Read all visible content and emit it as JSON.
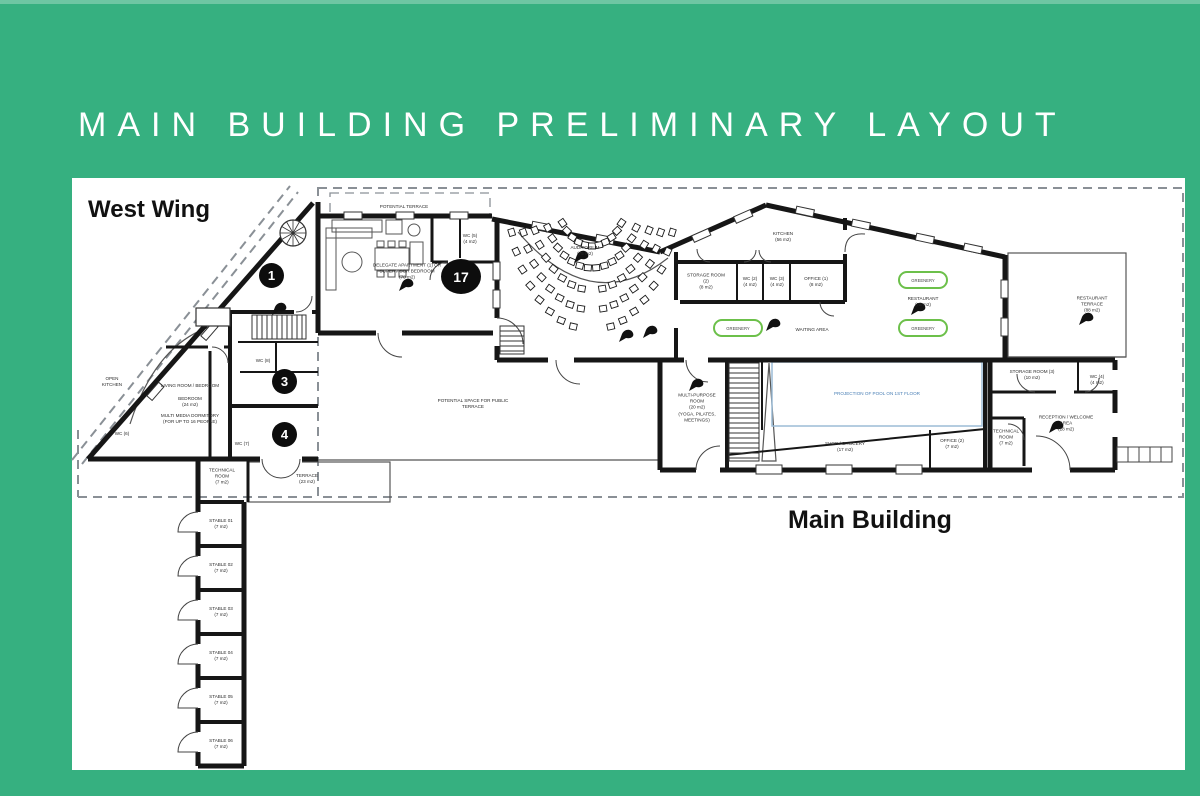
{
  "title": "MAIN BUILDING PRELIMINARY LAYOUT",
  "sections": {
    "west_wing": "West Wing",
    "main_building": "Main Building"
  },
  "colors": {
    "background": "#36B080",
    "wall": "#161616",
    "greenery": "#6CC04A",
    "pool_line": "#9CBCD6",
    "pool_text": "#4A7FB5",
    "dashed": "#8A9096"
  },
  "markers": {
    "m1": "1",
    "m3": "3",
    "m4": "4",
    "m17": "17"
  },
  "greenery_label": "GREENERY",
  "rooms": {
    "auditorium": {
      "name": "AUDITORIUM",
      "area": "(75 m2)"
    },
    "apartment": {
      "name": "DELEGATE APARTMENT (1) OR SUPERVISOR BEDROOM",
      "area": "(78 m2)"
    },
    "potential_terrace": {
      "name": "POTENTIAL TERRACE",
      "area": ""
    },
    "wc5": {
      "name": "WC (5)",
      "area": "(4 m2)"
    },
    "storage2": {
      "name": "STORAGE ROOM (2)",
      "area": "(8 m2)"
    },
    "wc2": {
      "name": "WC (2)",
      "area": "(4 m2)"
    },
    "wc3": {
      "name": "WC (3)",
      "area": "(4 m2)"
    },
    "office1": {
      "name": "OFFICE (1)",
      "area": "(8 m2)"
    },
    "kitchen": {
      "name": "KITCHEN",
      "area": "(56 m2)"
    },
    "waiting": {
      "name": "WAITING AREA",
      "area": ""
    },
    "restaurant": {
      "name": "RESTAURANT",
      "area": "(78 m2)"
    },
    "restaurant_terrace": {
      "name": "RESTAURANT TERRACE",
      "area": "(88 m2)"
    },
    "public_terrace": {
      "name": "POTENTIAL SPACE FOR PUBLIC TERRACE",
      "area": ""
    },
    "multipurpose": {
      "name": "MULTI-PURPOSE ROOM",
      "area": "(20 m2)",
      "note": "(YOGA, PILATES, MEETINGS)"
    },
    "pool": {
      "name": "PROJECTION OF POOL ON 1ST FLOOR"
    },
    "shop": {
      "name": "SHOP / GROCERY",
      "area": "(17 m2)"
    },
    "office2": {
      "name": "OFFICE (2)",
      "area": "(7 m2)"
    },
    "storage3": {
      "name": "STORAGE ROOM (3)",
      "area": "(10 m2)"
    },
    "wc4": {
      "name": "WC (4)",
      "area": "(4 m2)"
    },
    "reception": {
      "name": "RECEPTION / WELCOME AREA",
      "area": "(28 m2)"
    },
    "technical2": {
      "name": "TECHNICAL ROOM",
      "area": "(7 m2)"
    },
    "technical1": {
      "name": "TECHNICAL ROOM",
      "area": "(7 m2)"
    },
    "terrace_west": {
      "name": "TERRACE",
      "area": "(23 m2)"
    },
    "living": {
      "name": "LIVING ROOM / BEDROOM",
      "area": ""
    },
    "bedroom": {
      "name": "BEDROOM",
      "area": "(24 m2)"
    },
    "dormitory": {
      "name": "MULTI MEDIA DORMITORY",
      "area": "(FOR UP TO 16 PEOPLE)"
    },
    "open_kitchen": {
      "name": "OPEN KITCHEN",
      "area": ""
    },
    "wc6": {
      "name": "WC (6)",
      "area": ""
    },
    "wc7": {
      "name": "WC (7)",
      "area": ""
    },
    "wc8": {
      "name": "WC (8)",
      "area": ""
    }
  },
  "stables": [
    {
      "name": "STABLE 01",
      "area": "(7 m2)"
    },
    {
      "name": "STABLE 02",
      "area": "(7 m2)"
    },
    {
      "name": "STABLE 03",
      "area": "(7 m2)"
    },
    {
      "name": "STABLE 04",
      "area": "(7 m2)"
    },
    {
      "name": "STABLE 05",
      "area": "(7 m2)"
    },
    {
      "name": "STABLE 06",
      "area": "(7 m2)"
    }
  ]
}
